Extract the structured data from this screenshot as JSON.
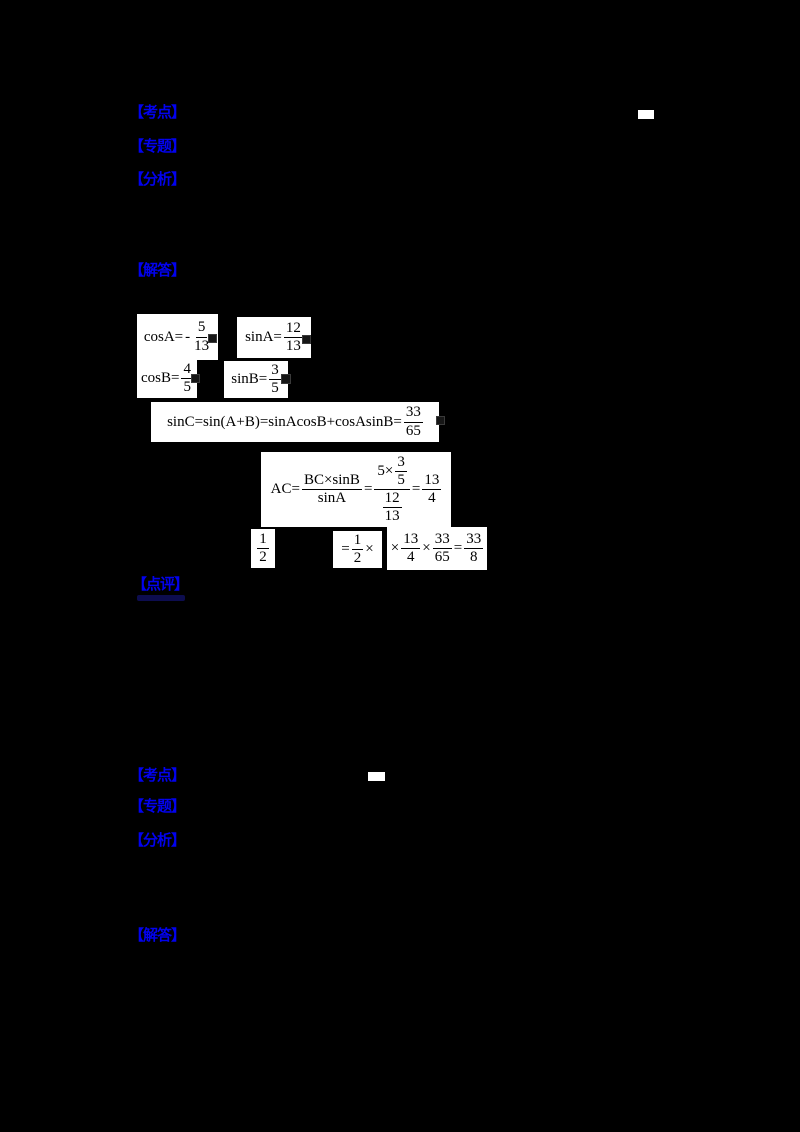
{
  "colors": {
    "background": "#000000",
    "label_blue": "#0202ee",
    "patch_background": "#ffffff",
    "ink": "#000000"
  },
  "sections": {
    "q1": {
      "kaodian": "【考点】",
      "zhuanti": "【专题】",
      "fenxi": "【分析】",
      "jieda": "【解答】",
      "dianping": "【点评】"
    },
    "q2": {
      "kaodian": "【考点】",
      "zhuanti": "【专题】",
      "fenxi": "【分析】",
      "jieda": "【解答】"
    }
  },
  "formulas": {
    "cosA": {
      "lhs": "cosA=",
      "sign": "-",
      "num": "5",
      "den": "13"
    },
    "sinA": {
      "lhs": "sinA=",
      "num": "12",
      "den": "13"
    },
    "cosB": {
      "lhs": "cosB=",
      "num": "4",
      "den": "5"
    },
    "sinB": {
      "lhs": "sinB=",
      "num": "3",
      "den": "5"
    },
    "sinC": {
      "lhs": "sinC=sin(A+B)=sinAcosB+cosAsinB=",
      "num": "33",
      "den": "65"
    },
    "ac": {
      "lhs": "AC=",
      "bc_num": "BC×sinB",
      "bc_den": "sinA",
      "eq1": "=",
      "num_pre": "5×",
      "nf_num": "3",
      "nf_den": "5",
      "df_num": "12",
      "df_den": "13",
      "eq2": "=",
      "res_num": "13",
      "res_den": "4"
    },
    "half": {
      "num": "1",
      "den": "2"
    },
    "half2": {
      "eq": "=",
      "num": "1",
      "den": "2",
      "times": "×"
    },
    "tail": {
      "times1": "×",
      "f1n": "13",
      "f1d": "4",
      "times2": "×",
      "f2n": "33",
      "f2d": "65",
      "eq": "=",
      "f3n": "33",
      "f3d": "8"
    }
  }
}
